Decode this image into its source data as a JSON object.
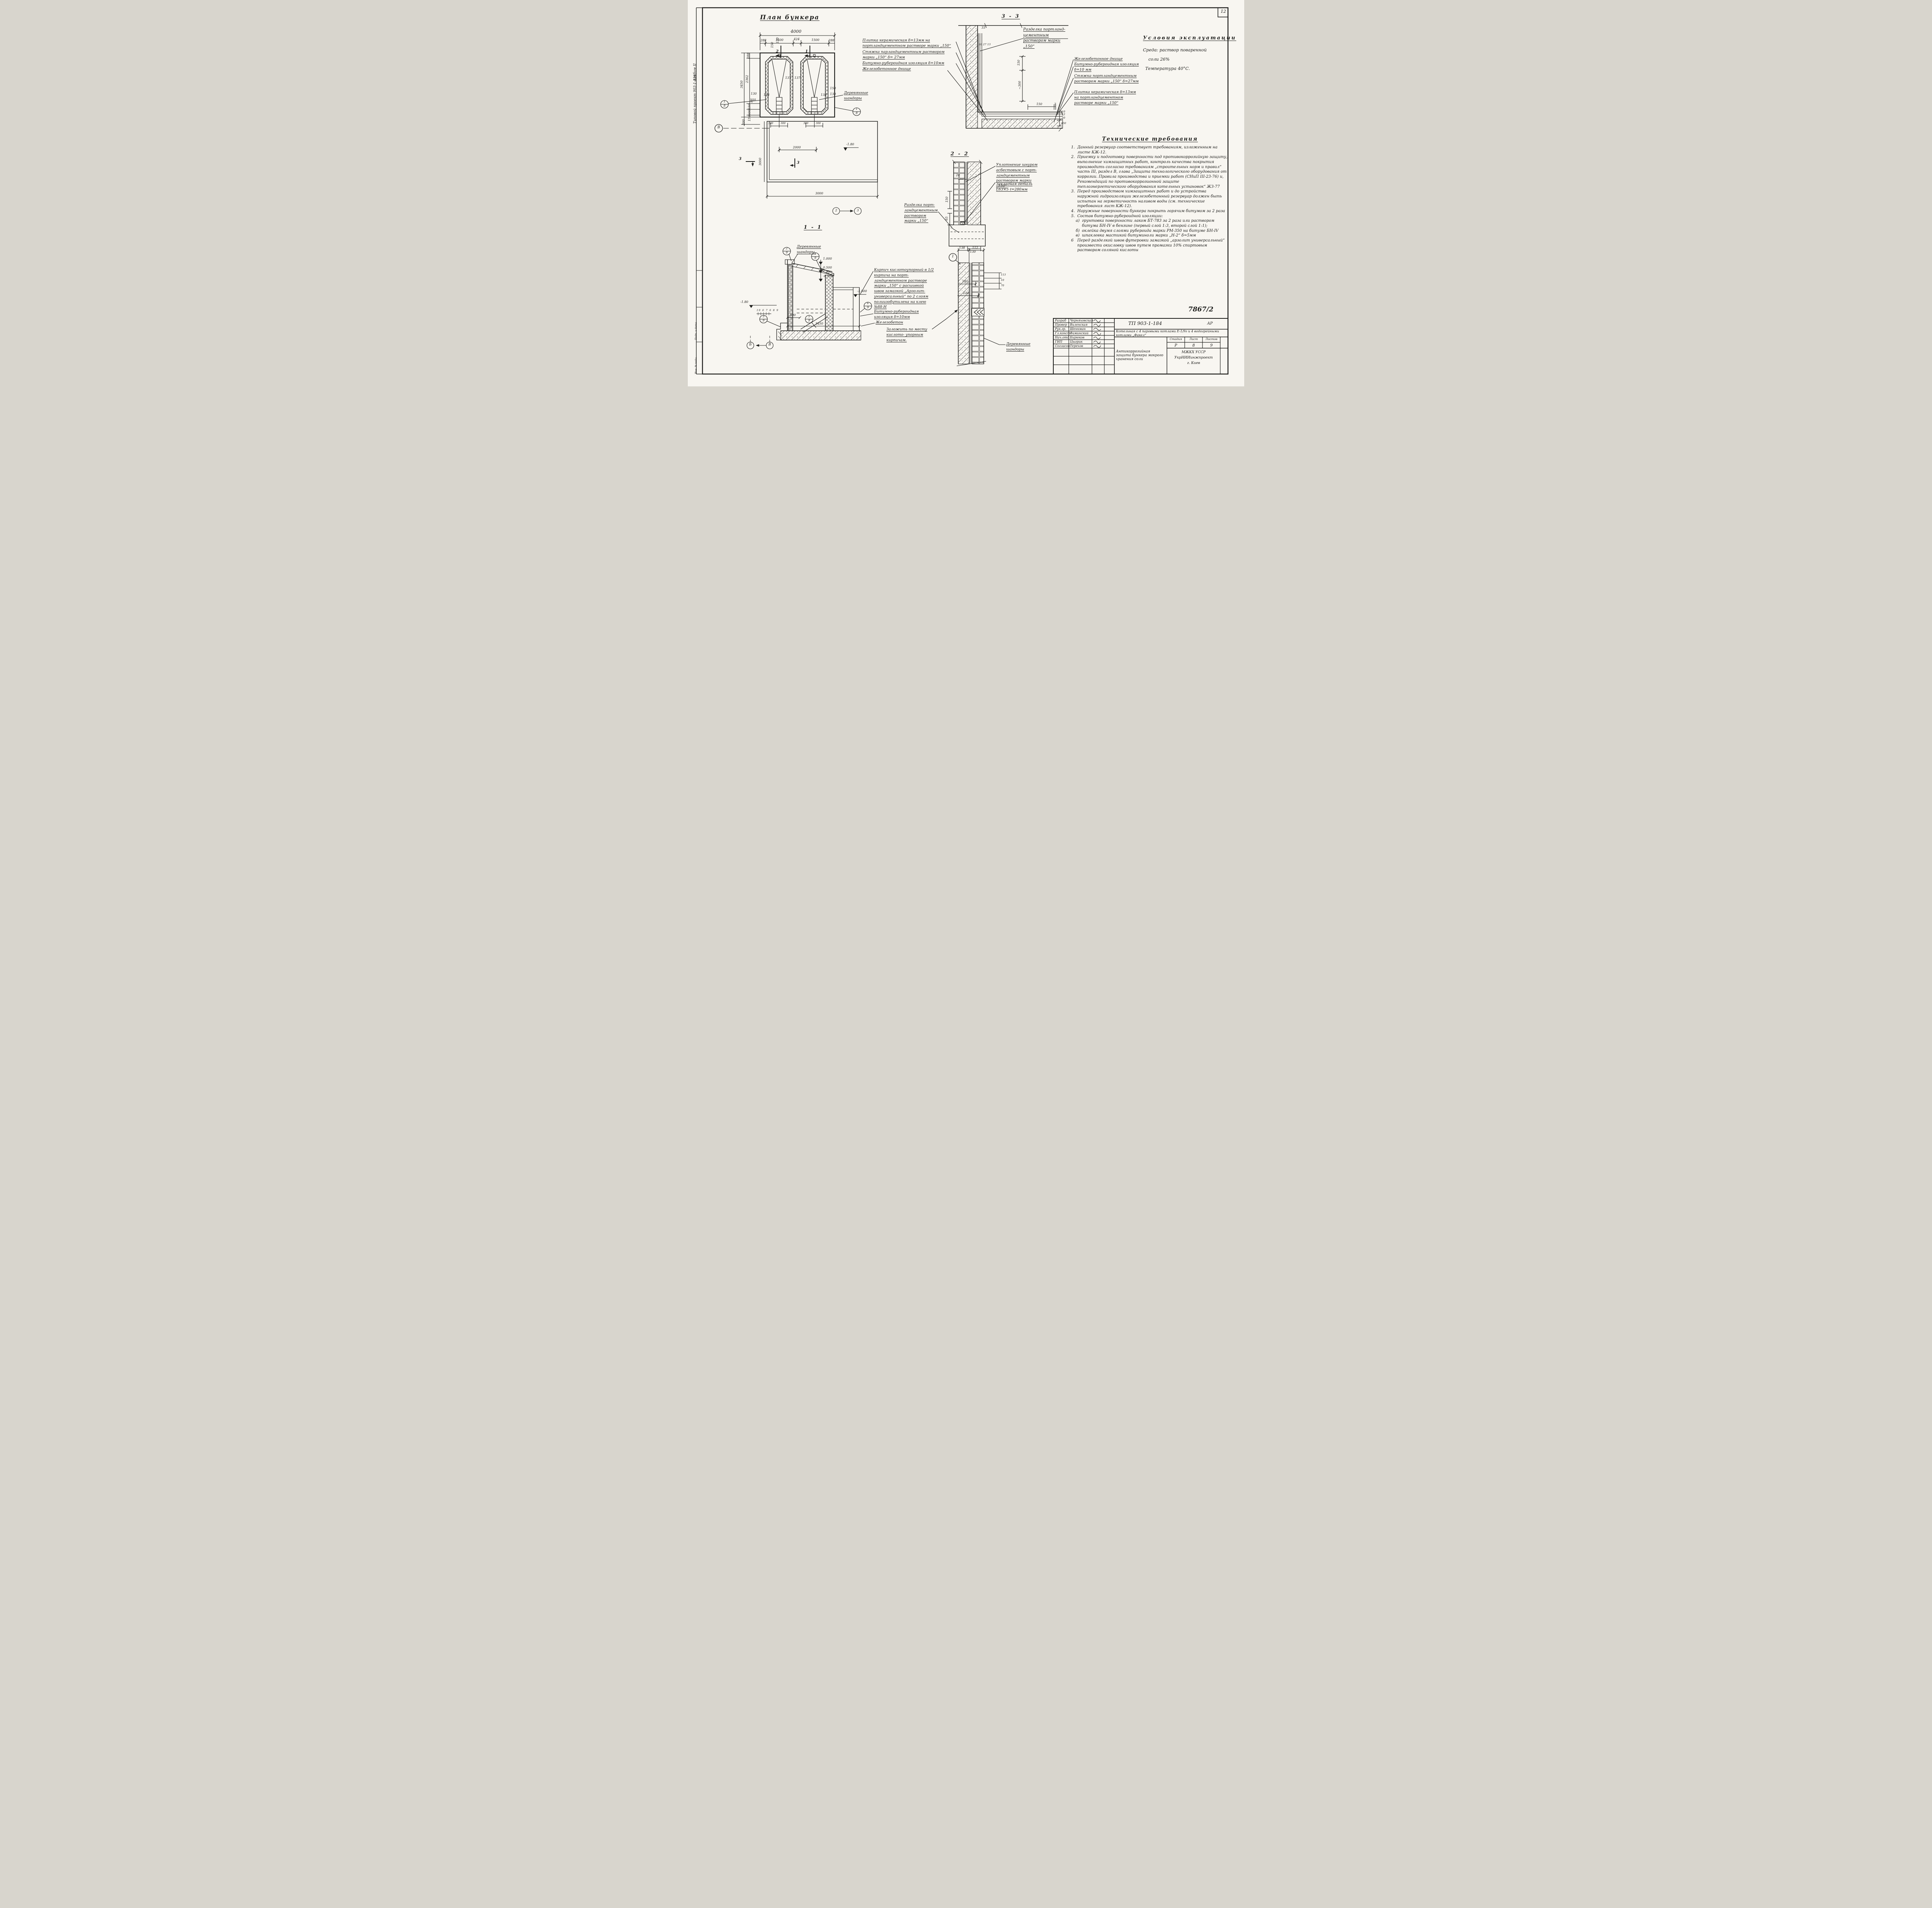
{
  "page": {
    "sheet_corner": "12",
    "doc_number": "7867/2"
  },
  "margin": {
    "project": "Типовой проект 903-1-184",
    "album": "Альбом II",
    "stamp_top": "Подп. и дата",
    "stamp_bottom": "Инв. № подл."
  },
  "plan": {
    "title": "План бункера",
    "dim_total": "4000",
    "dims_top": [
      "288",
      "1500",
      "424",
      "1500",
      "288"
    ],
    "dims_inner": [
      "130",
      "150",
      "137",
      "137",
      "138",
      "138",
      "130",
      "130",
      "150",
      "150"
    ],
    "dims_left": [
      "288",
      "2362",
      "3450",
      "150",
      "600",
      "150",
      "50",
      "200"
    ],
    "dims_bottom": [
      "300",
      "300",
      "300",
      "300",
      "2000",
      "3000"
    ],
    "dim_pit_left": "3000",
    "elevation": "-1.80",
    "mark_1": "1",
    "mark_2": "2",
    "mark_3a": "3",
    "mark_3b": "3",
    "ref_2": "2",
    "ref_3": "3",
    "axis_left": "В",
    "detail_num": "1",
    "detail_den": "8",
    "label_shandory": "Деревянные шандоры"
  },
  "section33": {
    "title": "3 - 3",
    "notes_left": [
      "Плитка керамическая  δ=13мм на портландцементном растворе марки „150“",
      "Стяжка парландцементным раствором марки „150“  δ= 27мм",
      "Битумно-рубероидная изоляция δ=10мм",
      "Железобетонное днище"
    ],
    "note_corner": "Разделка портланд-цементным раствором марки „150“",
    "notes_right": [
      "Железобетонное днище",
      "Битумно-рубероидная изоляция  δ=10 мм",
      "Стяжка портландцементным раствором марки „150“ δ=27мм",
      "Плитка керамическая δ=13мм на портландцементном растворе марки „150“"
    ],
    "dim_33": "33",
    "dims_layers": [
      "10",
      "27",
      "13"
    ],
    "dim_v1": "150",
    "dim_v2": "~300",
    "dim_h1": "150",
    "dim_h2": "3",
    "dims_chain": [
      "10",
      "12",
      "50"
    ],
    "dim_bottom": "150"
  },
  "conditions": {
    "title": "Условия эксплуатации",
    "line1": "Среда: раствор поваренной",
    "line2": "соли 26%",
    "line3": "Температура 40°С."
  },
  "requirements": {
    "title": "Технические требования",
    "items": [
      {
        "num": "1.",
        "text": "Данный резервуар соответствует требованиям, изложенным на листе КЖ-12."
      },
      {
        "num": "2.",
        "text": "Приемку и подготовку поверхности под противокоррозийную защиту, выполнение химзащитных работ, контроль качества покрытия производить согласно требованиям „строительных норм и правил“ часть III, раздел В, глава „Защита технологического оборудования от коррозии. Правила производства и приемки работ (СНиП III-23-76) и, Рекомендаций по противокоррозионной защите теплоэнергетического оборудования котельных установок“ ЖЗ-77"
      },
      {
        "num": "3.",
        "text": "Перед производством химзащитных работ и до устройства наружной гидроизоляции железобетонный резервуар должен быть испытан на герметичность наливом воды (см. технические требования лист КЖ-12)."
      },
      {
        "num": "4.",
        "text": "Наружные поверхности бункера покрыть горячим битумом за 2 раза"
      },
      {
        "num": "5.",
        "text": "Состав битумно-рубероидной изоляции:"
      },
      {
        "num": "а)",
        "text": "грунтовка поверхности лаком БТ-783 за 2 раза или раствором битума БН-IV в бензине (первый слой 1:3, второй слой 1:1);"
      },
      {
        "num": "б)",
        "text": "оклейка двумя слоями рубероида марки РМ-350 на битуме БН-IV"
      },
      {
        "num": "в)",
        "text": "шпаклевка мастикой битуминоли марки „Н-2“ δ=5мм"
      },
      {
        "num": "6",
        "text": "Перед разделкой швов футеровки замазкой „арзолит универсальный“ произвести окисловку швов путем промазки 10% спиртовым раствором соляной кислоты"
      }
    ]
  },
  "section22": {
    "title": "2 - 2",
    "note_seal": "Уплотнение шнуром асбестовым с порт- ландцементным раствором марки „150“",
    "note_embed": "Закладная деталь L63×5  ℓ=280мм",
    "note_razdelka": "Разделка порт- ландцементным раствором марки „150“",
    "dim_20": "20",
    "dim_150": "150",
    "dim_65": "65",
    "dim_5": "5",
    "dim_130": "130"
  },
  "detail22": {
    "detail_ref": "1",
    "dims_top": [
      "138",
      "112"
    ],
    "dim_180": "180",
    "dim_230": "230",
    "dims_right": [
      "113",
      "10",
      "70"
    ],
    "label_shandory": "Деревянные шандоры"
  },
  "section11": {
    "title": "1 - 1",
    "label_shandory": "Деревянные шандоры",
    "note_brick": "Кирпич кислотоупорный в 1/2 кирпича на порт- ландцементном растворе марки „150“ с расшивкой швов замазкой „Арзолит- универсальный“ по 2 слоям полиизобутилена на клею №88-Н",
    "note_insul": "Битумно-рубероидная изоляция  δ=10мм",
    "note_concrete": "Железобетон",
    "note_fill": "Заложить по месту кислото- упорным кирпичам.",
    "elev_1": "1.000",
    "elev_2": "0.500",
    "elev_3": "-0.150",
    "elev_4": "-1.500",
    "elev_left": "-1.80",
    "dim_500": "500",
    "dim_3450": "3450",
    "floor_marks": "10 6 7 6 8 9",
    "d1n": "2",
    "d1d": "9",
    "d2n": "4",
    "d2d": "9",
    "d3n": "3",
    "d3d": "9",
    "d4n": "6",
    "d4d": "9",
    "d5n": "5",
    "d5d": "9",
    "axis_a": "Б",
    "axis_b": "В"
  },
  "title_block": {
    "rows": [
      [
        "Разраб",
        "Черняховская"
      ],
      [
        "Провер",
        "Виленская"
      ],
      [
        "Рук.гр.",
        "Шенкман"
      ],
      [
        "Гл.конст",
        "Фаминский"
      ],
      [
        "Нач.отд",
        "Бирюков"
      ],
      [
        "ГИП",
        "Цыгрик"
      ],
      [
        "Согласов",
        "Терехов"
      ]
    ],
    "code": "ТП 903-1-184",
    "mark": "АР",
    "object": "Котельная с 4 паровыми котлами Е-1/9г и 4 водогрейными котлами „Факел“",
    "stage_label": "Стадия",
    "sheet_label": "Лист",
    "sheets_label": "Листов",
    "stage": "Р",
    "sheet": "8",
    "sheets": "9",
    "sheet_title": "Антикоррозийная защита бункера мокрого хранения соли",
    "org_line1": "МЖКХ УССР",
    "org_line2": "УкрНИИинжпроект",
    "org_line3": "г. Киев"
  }
}
